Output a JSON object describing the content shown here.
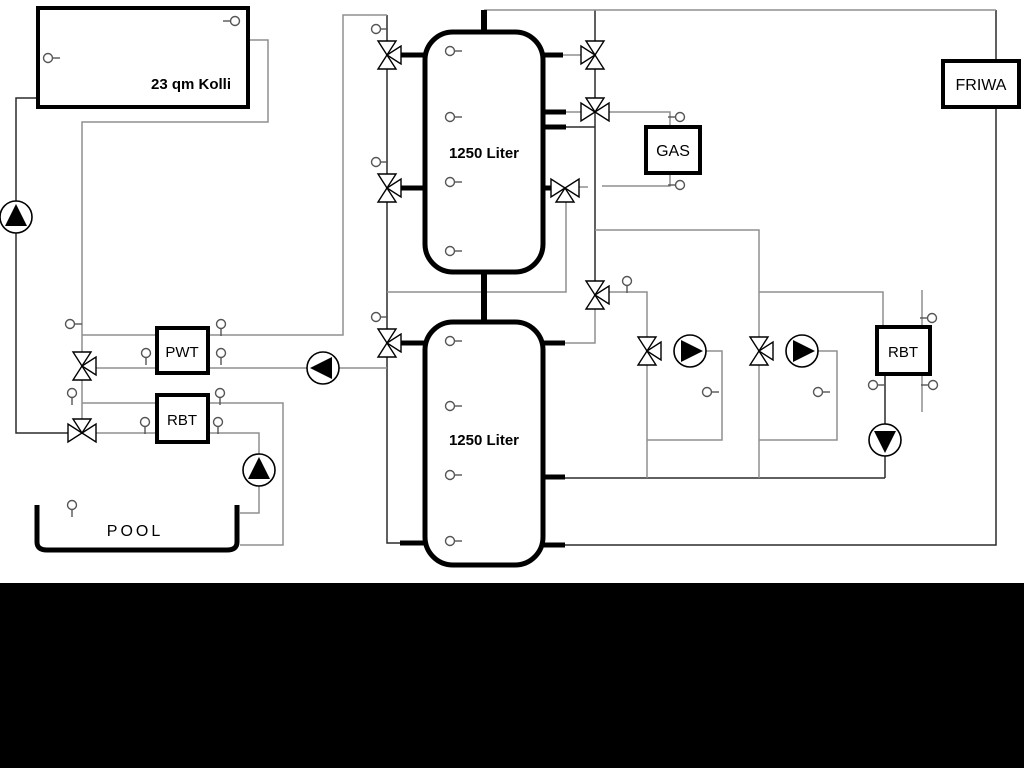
{
  "diagram_title": "Heating / solar / pool hydraulic schematic",
  "colors": {
    "background": "#ffffff",
    "bottom_bar": "#000000",
    "pipe_light": "#8f8f8f",
    "pipe_dark": "#2b2b2b",
    "component_stroke": "#000000",
    "component_fill": "#ffffff"
  },
  "canvas": {
    "width": 1024,
    "height": 768,
    "black_bar_y": 583
  },
  "boxes": [
    {
      "id": "collector-box",
      "label": "23 qm Kolli",
      "x": 38,
      "y": 8,
      "w": 210,
      "h": 99,
      "rx": 0,
      "stroke": 4,
      "lx": 191,
      "ly": 89,
      "fs": 15,
      "bold": true
    },
    {
      "id": "buffer-tank-top",
      "label": "1250 Liter",
      "x": 425,
      "y": 32,
      "w": 118,
      "h": 240,
      "rx": 28,
      "stroke": 5,
      "lx": 484,
      "ly": 158,
      "fs": 15,
      "bold": true
    },
    {
      "id": "buffer-tank-bottom",
      "label": "1250 Liter",
      "x": 425,
      "y": 322,
      "w": 118,
      "h": 243,
      "rx": 28,
      "stroke": 5,
      "lx": 484,
      "ly": 445,
      "fs": 15,
      "bold": true
    },
    {
      "id": "gas-boiler-box",
      "label": "GAS",
      "x": 646,
      "y": 127,
      "w": 54,
      "h": 46,
      "rx": 0,
      "stroke": 4,
      "lx": 673,
      "ly": 156,
      "fs": 16,
      "bold": false
    },
    {
      "id": "friwa-box",
      "label": "FRIWA",
      "x": 943,
      "y": 61,
      "w": 76,
      "h": 46,
      "rx": 0,
      "stroke": 4,
      "lx": 981,
      "ly": 90,
      "fs": 16,
      "bold": false
    },
    {
      "id": "pwt-box",
      "label": "PWT",
      "x": 157,
      "y": 328,
      "w": 51,
      "h": 45,
      "rx": 0,
      "stroke": 4,
      "lx": 182,
      "ly": 357,
      "fs": 15,
      "bold": false
    },
    {
      "id": "rbt-left-box",
      "label": "RBT",
      "x": 157,
      "y": 395,
      "w": 51,
      "h": 47,
      "rx": 0,
      "stroke": 4,
      "lx": 182,
      "ly": 425,
      "fs": 15,
      "bold": false
    },
    {
      "id": "rbt-right-box",
      "label": "RBT",
      "x": 877,
      "y": 327,
      "w": 53,
      "h": 47,
      "rx": 0,
      "stroke": 4,
      "lx": 903,
      "ly": 357,
      "fs": 15,
      "bold": false
    }
  ],
  "pool": {
    "label": "POOL",
    "x1": 37,
    "y_top": 505,
    "x2": 237,
    "y_bottom": 550,
    "stroke": 5,
    "lx": 135,
    "ly": 536,
    "fs": 16
  },
  "pipes": [
    {
      "name": "solar-cold-riser",
      "shade": "dark",
      "pts": [
        [
          38,
          98
        ],
        [
          16,
          98
        ],
        [
          16,
          433
        ],
        [
          68,
          433
        ]
      ]
    },
    {
      "name": "solar-hot-drop",
      "shade": "dark",
      "pts": [
        [
          387,
          15
        ],
        [
          387,
          543
        ],
        [
          400,
          543
        ]
      ]
    },
    {
      "name": "tank-right-main-vertical",
      "shade": "dark",
      "pts": [
        [
          595,
          10
        ],
        [
          595,
          281
        ]
      ]
    },
    {
      "name": "tank-port-link",
      "shade": "dark",
      "pts": [
        [
          566,
          127
        ],
        [
          595,
          127
        ]
      ]
    },
    {
      "name": "heating-return-line",
      "shade": "dark",
      "pts": [
        [
          565,
          478
        ],
        [
          885,
          478
        ]
      ]
    },
    {
      "name": "rbt-right-pump-line",
      "shade": "dark",
      "pts": [
        [
          885,
          478
        ],
        [
          885,
          374
        ]
      ]
    },
    {
      "name": "friwa-return-line",
      "shade": "dark",
      "pts": [
        [
          565,
          545
        ],
        [
          996,
          545
        ],
        [
          996,
          107
        ]
      ]
    },
    {
      "name": "friwa-supply-link",
      "shade": "dark",
      "pts": [
        [
          996,
          10
        ],
        [
          996,
          61
        ]
      ]
    },
    {
      "name": "collector-return-loop",
      "shade": "light",
      "pts": [
        [
          248,
          40
        ],
        [
          268,
          40
        ],
        [
          268,
          122
        ],
        [
          82,
          122
        ],
        [
          82,
          352
        ]
      ]
    },
    {
      "name": "pwt-column-link",
      "shade": "light",
      "pts": [
        [
          82,
          380
        ],
        [
          82,
          419
        ]
      ]
    },
    {
      "name": "pwt-primary-top",
      "shade": "light",
      "pts": [
        [
          82,
          335
        ],
        [
          343,
          335
        ],
        [
          343,
          15
        ],
        [
          387,
          15
        ]
      ]
    },
    {
      "name": "pwt-primary-bottom",
      "shade": "light",
      "pts": [
        [
          96,
          368
        ],
        [
          387,
          368
        ]
      ]
    },
    {
      "name": "rbt-pool-supply",
      "shade": "light",
      "pts": [
        [
          82,
          403
        ],
        [
          283,
          403
        ],
        [
          283,
          545
        ],
        [
          240,
          545
        ]
      ]
    },
    {
      "name": "rbt-pool-return",
      "shade": "light",
      "pts": [
        [
          96,
          433
        ],
        [
          259,
          433
        ],
        [
          259,
          513
        ],
        [
          240,
          513
        ]
      ]
    },
    {
      "name": "top-header-line",
      "shade": "light",
      "pts": [
        [
          484,
          10
        ],
        [
          996,
          10
        ]
      ]
    },
    {
      "name": "gas-mix-drop",
      "shade": "light",
      "pts": [
        [
          387,
          292
        ],
        [
          566,
          292
        ],
        [
          566,
          202
        ]
      ]
    },
    {
      "name": "valve-to-tank2-link",
      "shade": "light",
      "pts": [
        [
          595,
          309
        ],
        [
          595,
          343
        ],
        [
          565,
          343
        ]
      ]
    },
    {
      "name": "group1-supply",
      "shade": "light",
      "pts": [
        [
          609,
          292
        ],
        [
          647,
          292
        ],
        [
          647,
          337
        ]
      ]
    },
    {
      "name": "group1-return-drop",
      "shade": "light",
      "pts": [
        [
          647,
          365
        ],
        [
          647,
          478
        ]
      ]
    },
    {
      "name": "group2-header",
      "shade": "light",
      "pts": [
        [
          595,
          230
        ],
        [
          759,
          230
        ],
        [
          759,
          337
        ]
      ]
    },
    {
      "name": "rbt-right-supply",
      "shade": "light",
      "pts": [
        [
          759,
          292
        ],
        [
          883,
          292
        ],
        [
          883,
          327
        ]
      ]
    },
    {
      "name": "group2-return-drop",
      "shade": "light",
      "pts": [
        [
          759,
          365
        ],
        [
          759,
          478
        ]
      ]
    },
    {
      "name": "group1-pump-loop",
      "shade": "light",
      "pts": [
        [
          704,
          351
        ],
        [
          722,
          351
        ],
        [
          722,
          440
        ],
        [
          647,
          440
        ]
      ]
    },
    {
      "name": "group2-pump-loop",
      "shade": "light",
      "pts": [
        [
          816,
          351
        ],
        [
          837,
          351
        ],
        [
          837,
          440
        ],
        [
          759,
          440
        ]
      ]
    },
    {
      "name": "gas-supply-line",
      "shade": "light",
      "pts": [
        [
          609,
          112
        ],
        [
          670,
          112
        ],
        [
          670,
          127
        ]
      ]
    },
    {
      "name": "gas-return-line",
      "shade": "light",
      "pts": [
        [
          670,
          173
        ],
        [
          670,
          186
        ],
        [
          602,
          186
        ]
      ]
    },
    {
      "name": "gas-return-stub",
      "shade": "light",
      "pts": [
        [
          579,
          187
        ],
        [
          588,
          187
        ]
      ]
    },
    {
      "name": "rbt-right-sec-top",
      "shade": "light",
      "pts": [
        [
          922,
          290
        ],
        [
          922,
          327
        ]
      ]
    },
    {
      "name": "rbt-right-sec-bottom",
      "shade": "light",
      "pts": [
        [
          922,
          374
        ],
        [
          922,
          412
        ]
      ]
    },
    {
      "name": "valve-link-t1r1",
      "shade": "light",
      "pts": [
        [
          563,
          55
        ],
        [
          581,
          55
        ]
      ]
    },
    {
      "name": "valve-link-t1r2",
      "shade": "light",
      "pts": [
        [
          566,
          112
        ],
        [
          581,
          112
        ]
      ]
    }
  ],
  "stubs": [
    {
      "name": "tank1-left-port-1",
      "pts": [
        [
          400,
          55
        ],
        [
          426,
          55
        ]
      ],
      "w": 5
    },
    {
      "name": "tank1-left-port-2",
      "pts": [
        [
          400,
          188
        ],
        [
          426,
          188
        ]
      ],
      "w": 5
    },
    {
      "name": "tank1-right-port-1",
      "pts": [
        [
          542,
          55
        ],
        [
          563,
          55
        ]
      ],
      "w": 5
    },
    {
      "name": "tank1-right-port-2",
      "pts": [
        [
          542,
          112
        ],
        [
          566,
          112
        ]
      ],
      "w": 5
    },
    {
      "name": "tank1-right-port-3",
      "pts": [
        [
          542,
          127
        ],
        [
          566,
          127
        ]
      ],
      "w": 5
    },
    {
      "name": "tank1-right-port-4",
      "pts": [
        [
          542,
          188
        ],
        [
          551,
          188
        ]
      ],
      "w": 5
    },
    {
      "name": "tank2-left-port-1",
      "pts": [
        [
          400,
          343
        ],
        [
          426,
          343
        ]
      ],
      "w": 5
    },
    {
      "name": "tank2-left-port-2",
      "pts": [
        [
          400,
          543
        ],
        [
          426,
          543
        ]
      ],
      "w": 5
    },
    {
      "name": "tank2-right-port-1",
      "pts": [
        [
          542,
          343
        ],
        [
          565,
          343
        ]
      ],
      "w": 5
    },
    {
      "name": "tank2-right-port-2",
      "pts": [
        [
          542,
          477
        ],
        [
          565,
          477
        ]
      ],
      "w": 5
    },
    {
      "name": "tank2-right-port-3",
      "pts": [
        [
          542,
          545
        ],
        [
          565,
          545
        ]
      ],
      "w": 5
    },
    {
      "name": "tank1-top-stem",
      "pts": [
        [
          484,
          10
        ],
        [
          484,
          32
        ]
      ],
      "w": 6
    },
    {
      "name": "tank-connect-stem",
      "pts": [
        [
          484,
          272
        ],
        [
          484,
          322
        ]
      ],
      "w": 6
    }
  ],
  "valves": [
    {
      "name": "valve-pwt-supply",
      "x": 82,
      "y": 366,
      "type": "vr"
    },
    {
      "name": "valve-pool-mix",
      "x": 82,
      "y": 433,
      "type": "ht"
    },
    {
      "name": "valve-tank1-solar-top",
      "x": 387,
      "y": 55,
      "type": "vr"
    },
    {
      "name": "valve-tank1-solar-mid",
      "x": 387,
      "y": 188,
      "type": "vr"
    },
    {
      "name": "valve-tank2-solar",
      "x": 387,
      "y": 343,
      "type": "vr"
    },
    {
      "name": "valve-tank1-right-top",
      "x": 595,
      "y": 55,
      "type": "vl"
    },
    {
      "name": "valve-gas-supply",
      "x": 595,
      "y": 112,
      "type": "ht"
    },
    {
      "name": "valve-gas-return",
      "x": 565,
      "y": 188,
      "type": "hb"
    },
    {
      "name": "valve-heating-mix",
      "x": 595,
      "y": 295,
      "type": "vr"
    },
    {
      "name": "valve-group1",
      "x": 647,
      "y": 351,
      "type": "vr"
    },
    {
      "name": "valve-group2",
      "x": 759,
      "y": 351,
      "type": "vr"
    }
  ],
  "pumps": [
    {
      "name": "solar-pump",
      "x": 16,
      "y": 217,
      "dir": "up"
    },
    {
      "name": "pwt-pump",
      "x": 323,
      "y": 368,
      "dir": "left"
    },
    {
      "name": "pool-pump",
      "x": 259,
      "y": 470,
      "dir": "up"
    },
    {
      "name": "heating-pump-1",
      "x": 690,
      "y": 351,
      "dir": "right"
    },
    {
      "name": "heating-pump-2",
      "x": 802,
      "y": 351,
      "dir": "right"
    },
    {
      "name": "rbt-return-pump",
      "x": 885,
      "y": 440,
      "dir": "down"
    }
  ],
  "sensors": [
    {
      "x": 48,
      "y": 58,
      "dir": "right"
    },
    {
      "x": 235,
      "y": 21,
      "dir": "left"
    },
    {
      "x": 450,
      "y": 51,
      "dir": "right"
    },
    {
      "x": 450,
      "y": 117,
      "dir": "right"
    },
    {
      "x": 450,
      "y": 182,
      "dir": "right"
    },
    {
      "x": 450,
      "y": 251,
      "dir": "right"
    },
    {
      "x": 450,
      "y": 341,
      "dir": "right"
    },
    {
      "x": 450,
      "y": 406,
      "dir": "right"
    },
    {
      "x": 450,
      "y": 475,
      "dir": "right"
    },
    {
      "x": 450,
      "y": 541,
      "dir": "right"
    },
    {
      "x": 376,
      "y": 29,
      "dir": "right"
    },
    {
      "x": 376,
      "y": 162,
      "dir": "right"
    },
    {
      "x": 376,
      "y": 317,
      "dir": "right"
    },
    {
      "x": 70,
      "y": 324,
      "dir": "right"
    },
    {
      "x": 221,
      "y": 324,
      "dir": "down"
    },
    {
      "x": 146,
      "y": 353,
      "dir": "down"
    },
    {
      "x": 221,
      "y": 353,
      "dir": "down"
    },
    {
      "x": 72,
      "y": 393,
      "dir": "down"
    },
    {
      "x": 220,
      "y": 393,
      "dir": "down"
    },
    {
      "x": 145,
      "y": 422,
      "dir": "down"
    },
    {
      "x": 218,
      "y": 422,
      "dir": "down"
    },
    {
      "x": 72,
      "y": 505,
      "dir": "down"
    },
    {
      "x": 680,
      "y": 117,
      "dir": "left"
    },
    {
      "x": 680,
      "y": 185,
      "dir": "left"
    },
    {
      "x": 627,
      "y": 281,
      "dir": "down"
    },
    {
      "x": 707,
      "y": 392,
      "dir": "right"
    },
    {
      "x": 818,
      "y": 392,
      "dir": "right"
    },
    {
      "x": 932,
      "y": 318,
      "dir": "left"
    },
    {
      "x": 873,
      "y": 385,
      "dir": "right"
    },
    {
      "x": 933,
      "y": 385,
      "dir": "left"
    }
  ]
}
